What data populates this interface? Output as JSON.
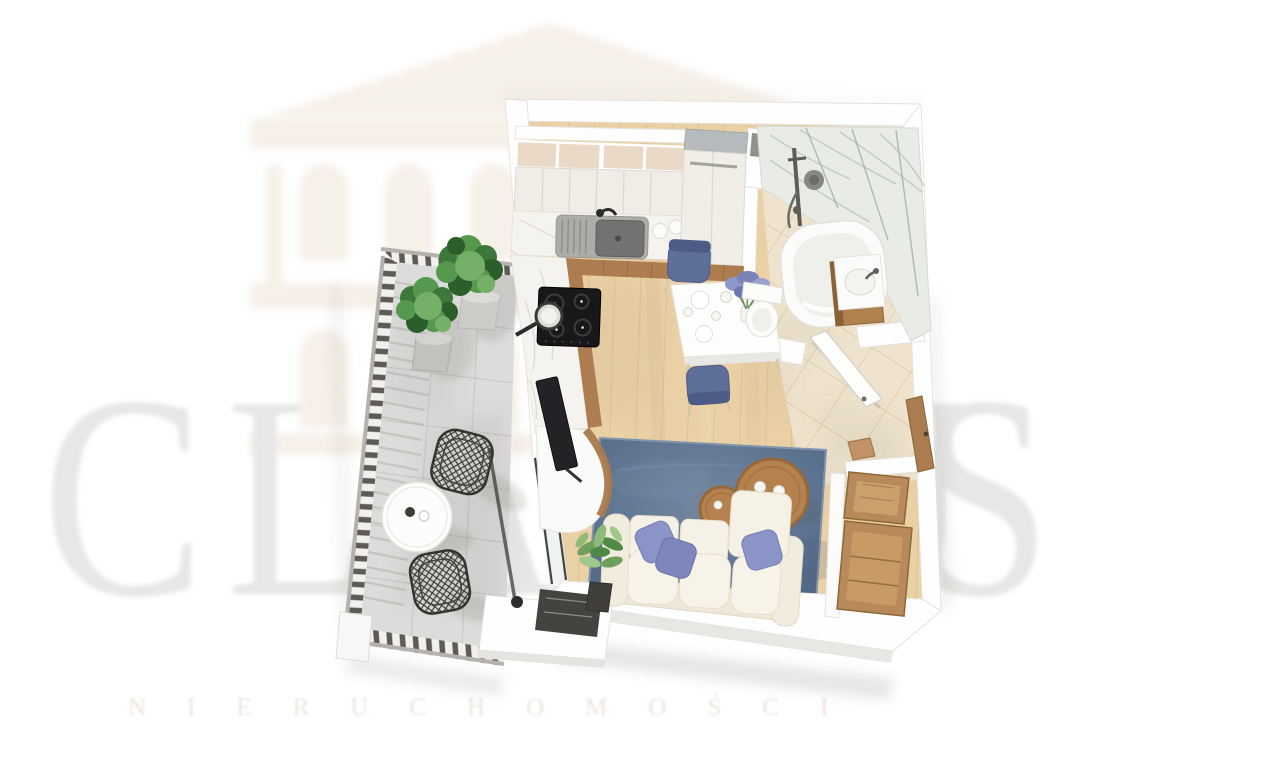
{
  "watermark": {
    "brand_word": "CLASSUS",
    "brand_letters": [
      {
        "ch": "C",
        "x": 42
      },
      {
        "ch": "L",
        "x": 226
      },
      {
        "ch": "A",
        "x": 385
      },
      {
        "ch": "S",
        "x": 543
      },
      {
        "ch": "S",
        "x": 683
      },
      {
        "ch": "U",
        "x": 795
      },
      {
        "ch": "S",
        "x": 916
      }
    ],
    "subtitle": "NIERUCHOMOŚCI"
  },
  "palette": {
    "page_bg": "#ffffff",
    "watermark_letter": "#e8e7e5",
    "watermark_beige": "#f0e7da",
    "subtitle_color": "#ece5dd",
    "wall": "#fefefe",
    "wall_edge": "#e4e1dc",
    "wall_face": "#e9e7e3",
    "wood_floor": "#ead0a5",
    "wood_line": "#c99e6c",
    "tile_floor": "#efe3cd",
    "tile_line": "#d6c3a3",
    "balcony_tile": "#dcdcda",
    "balcony_line": "#c8c8c6",
    "rug_mid": "#5e7593",
    "marble": "#f5f3ef",
    "marble_wall": "#e8ebe6",
    "wood_furniture": "#ad7c50",
    "wood_dark": "#8f6838",
    "sofa_cream": "#f4eee1",
    "pillow_blue": "#8b94c6",
    "chair_blue": "#5e6f99",
    "plant_green": "#4a8743",
    "metal_dark": "#3b3a36",
    "appliance_black": "#18181a",
    "railing_slat": "#5e5b55",
    "shadow": "#6b665c"
  }
}
